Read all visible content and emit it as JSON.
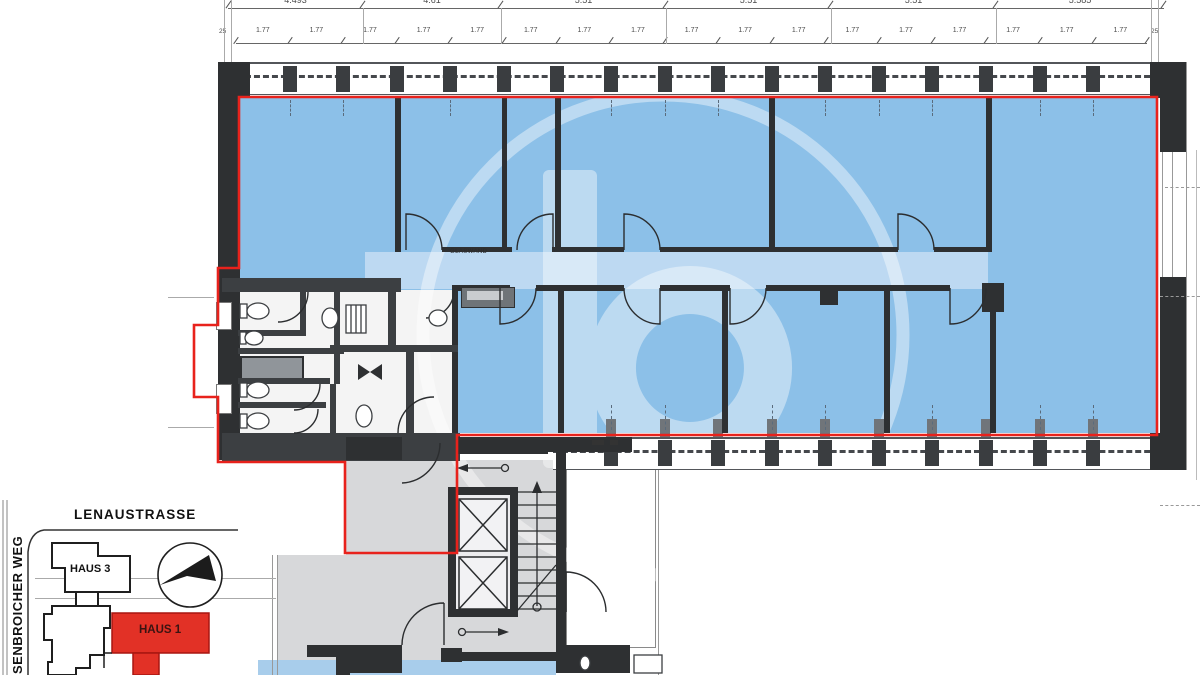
{
  "document": {
    "kind": "architectural floor plan scan",
    "highlight_note": "rental unit highlighted blue with red outline"
  },
  "dimensions": {
    "row1": [
      "4.493",
      "4.61",
      "5.51",
      "5.51",
      "5.51",
      "5.585"
    ],
    "row2": [
      "1.77",
      "1.77",
      "1.77",
      "1.77",
      "1.77",
      "1.77",
      "1.77",
      "1.77",
      "1.77",
      "1.77",
      "1.77",
      "1.77",
      "1.77",
      "1.77",
      "1.77",
      "1.77",
      "1.77"
    ],
    "edge_left": "25",
    "edge_right": "25"
  },
  "plan": {
    "glaswand_label": "GLASWAND"
  },
  "watermark": {
    "letter": "b",
    "icon": "b-logo-watermark-icon"
  },
  "map": {
    "street_top": "LENAUSTRASSE",
    "street_left": "SENBROICHER WEG",
    "haus3_label": "HAUS 3",
    "haus1_label": "HAUS 1",
    "north_arrow_icon": "north-arrow-icon"
  },
  "colors": {
    "unit_fill": "#8cc0e8",
    "corridor_fill": "#bdd9f2",
    "outline_red": "#e8221c",
    "haus1_red": "#e23126",
    "wall_dark": "#2e3032",
    "core_floor": "#d7d8da",
    "lower_blue": "#a8cdeb"
  }
}
